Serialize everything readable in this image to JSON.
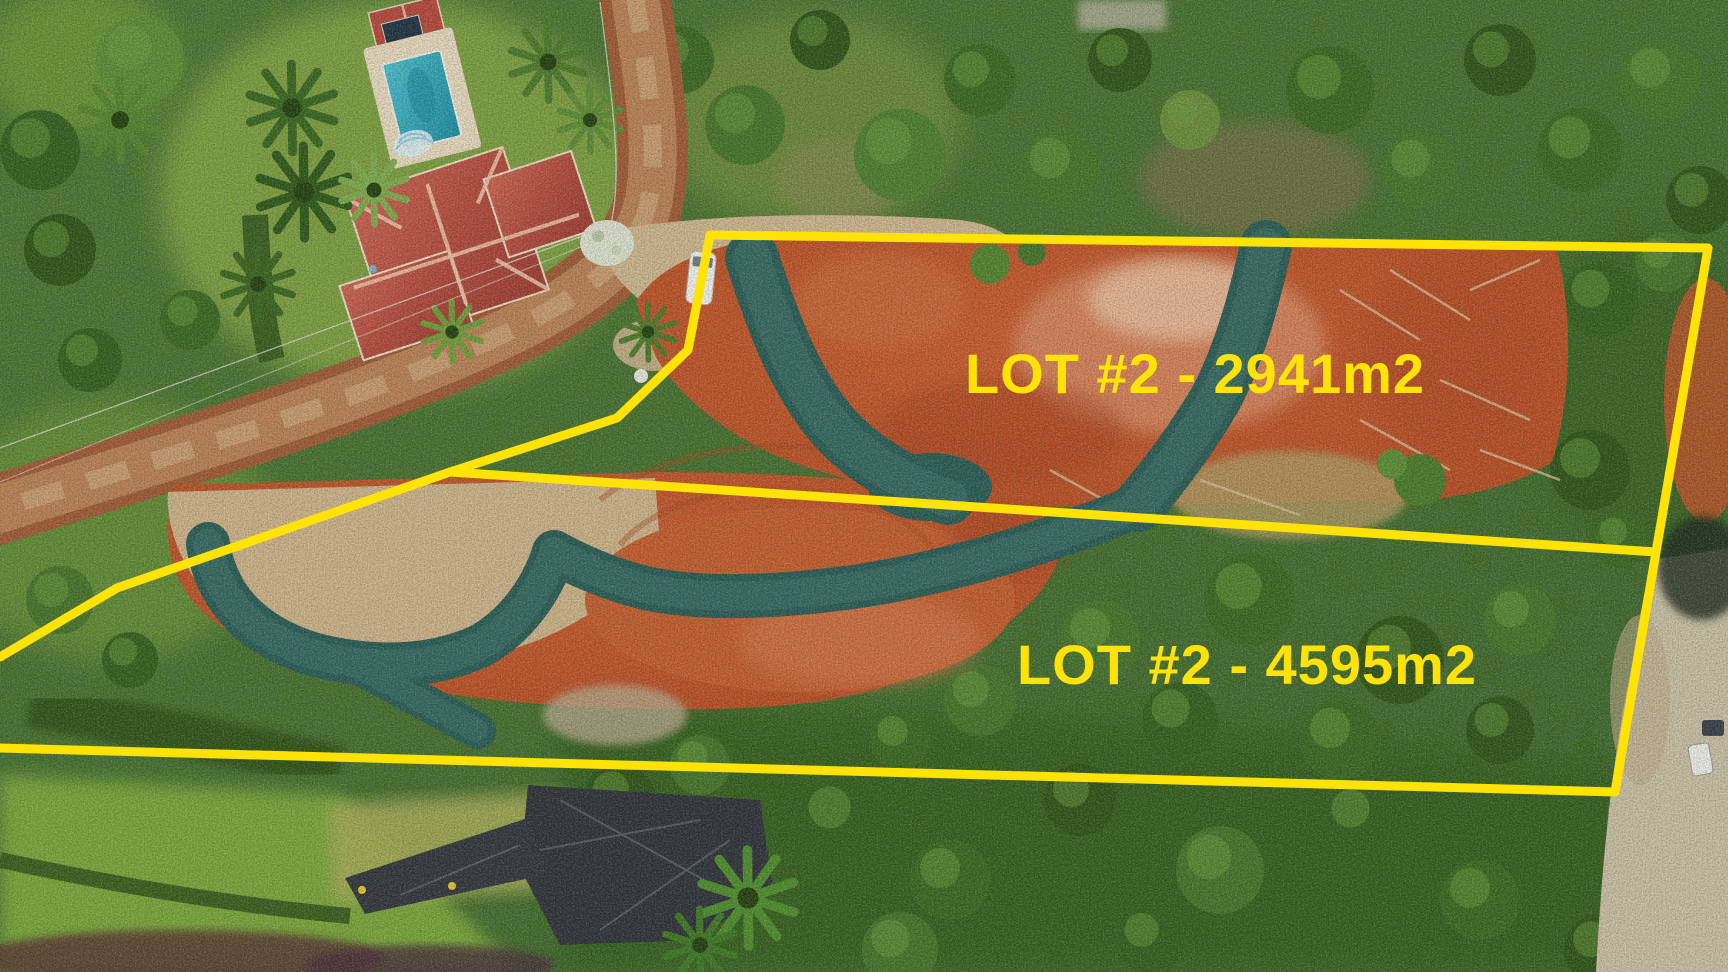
{
  "meta": {
    "type": "aerial-drone-photo",
    "subject": "cleared land lots with surveyed boundary overlay"
  },
  "overlay": {
    "line_color": "#ffe206",
    "label_color": "#ffe206",
    "lots": [
      {
        "label": "LOT #2 - 2941m2"
      },
      {
        "label": "LOT #2 - 4595m2"
      }
    ]
  },
  "photo_features": [
    "tile-roof-house",
    "swimming-pool",
    "pool-house-with-solar-panel",
    "dirt-road",
    "gravel-entrance-pad",
    "cleared-red-earth",
    "erosion-control-wattle-bands",
    "black-ground-tarp",
    "white-van",
    "parked-cars",
    "forest-vegetation"
  ]
}
